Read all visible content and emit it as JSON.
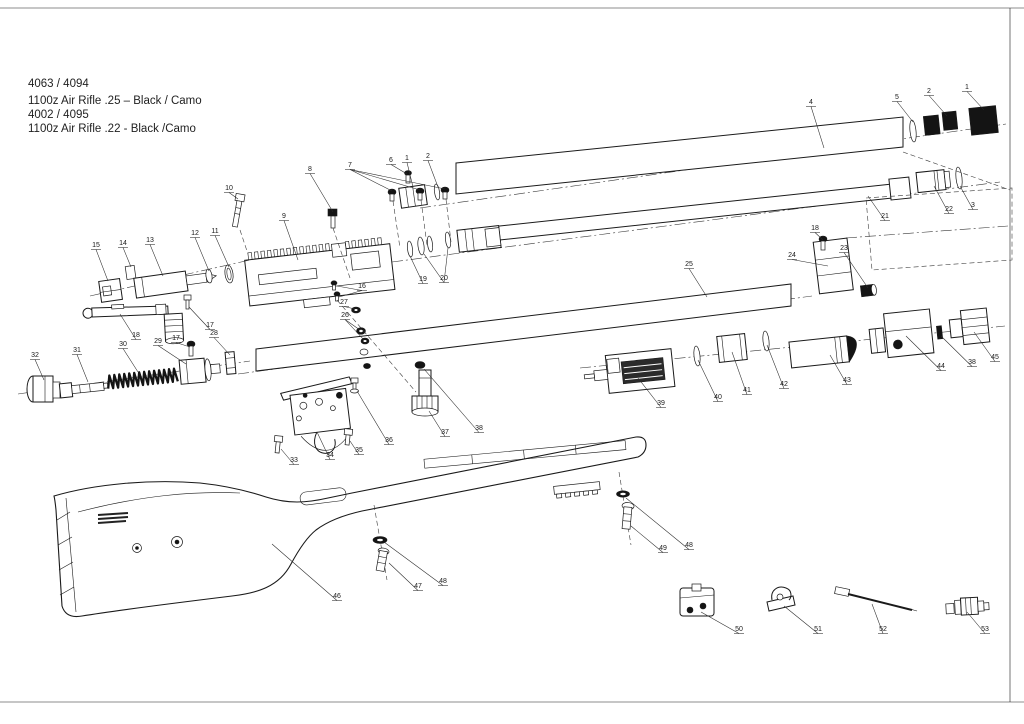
{
  "title_block": {
    "line1": "4063 / 4094",
    "line2": "1100z Air Rifle .25 – Black / Camo",
    "line3": "4002 / 4095",
    "line4": "1100z Air Rifle .22 - Black /Camo"
  },
  "diagram": {
    "type": "exploded-parts-diagram",
    "subject": "1100z PCP air rifle exploded view",
    "line_color": "#1a1a1a",
    "part_labels": [
      {
        "n": "1",
        "x": 967,
        "y": 89,
        "leaders": [
          [
            984,
            110
          ]
        ]
      },
      {
        "n": "2",
        "x": 929,
        "y": 93,
        "leaders": [
          [
            947,
            116
          ]
        ]
      },
      {
        "n": "5",
        "x": 897,
        "y": 99,
        "leaders": [
          [
            913,
            122
          ]
        ]
      },
      {
        "n": "4",
        "x": 811,
        "y": 104,
        "leaders": [
          [
            824,
            148
          ]
        ]
      },
      {
        "n": "3",
        "x": 973,
        "y": 207,
        "leaders": [
          [
            960,
            186
          ]
        ]
      },
      {
        "n": "22",
        "x": 949,
        "y": 211,
        "leaders": [
          [
            934,
            186
          ]
        ]
      },
      {
        "n": "21",
        "x": 885,
        "y": 218,
        "leaders": [
          [
            868,
            196
          ]
        ]
      },
      {
        "n": "18",
        "x": 815,
        "y": 230,
        "leaders": [
          [
            823,
            240
          ]
        ]
      },
      {
        "n": "23",
        "x": 844,
        "y": 250,
        "leaders": [
          [
            868,
            288
          ]
        ]
      },
      {
        "n": "24",
        "x": 792,
        "y": 257,
        "leaders": [
          [
            828,
            266
          ]
        ]
      },
      {
        "n": "25",
        "x": 689,
        "y": 266,
        "leaders": [
          [
            707,
            297
          ]
        ]
      },
      {
        "n": "9",
        "x": 284,
        "y": 218,
        "leaders": [
          [
            298,
            260
          ]
        ]
      },
      {
        "n": "10",
        "x": 229,
        "y": 190,
        "leaders": [
          [
            238,
            199
          ]
        ]
      },
      {
        "n": "8",
        "x": 310,
        "y": 171,
        "leaders": [
          [
            333,
            212
          ]
        ]
      },
      {
        "n": "7",
        "x": 350,
        "y": 167,
        "leaders": [
          [
            392,
            191
          ],
          [
            420,
            190
          ],
          [
            445,
            189
          ]
        ]
      },
      {
        "n": "6",
        "x": 391,
        "y": 162,
        "leaders": [
          [
            407,
            174
          ]
        ]
      },
      {
        "n": "1",
        "x": 407,
        "y": 160,
        "leaders": [
          [
            413,
            187
          ]
        ]
      },
      {
        "n": "2",
        "x": 428,
        "y": 158,
        "leaders": [
          [
            438,
            187
          ]
        ]
      },
      {
        "n": "19",
        "x": 423,
        "y": 281,
        "leaders": [
          [
            410,
            256
          ]
        ]
      },
      {
        "n": "20",
        "x": 444,
        "y": 280,
        "leaders": [
          [
            424,
            254
          ],
          [
            448,
            248
          ]
        ]
      },
      {
        "n": "15",
        "x": 96,
        "y": 247,
        "leaders": [
          [
            108,
            281
          ]
        ]
      },
      {
        "n": "14",
        "x": 123,
        "y": 245,
        "leaders": [
          [
            131,
            267
          ]
        ]
      },
      {
        "n": "13",
        "x": 150,
        "y": 242,
        "leaders": [
          [
            163,
            276
          ]
        ]
      },
      {
        "n": "12",
        "x": 195,
        "y": 235,
        "leaders": [
          [
            209,
            271
          ]
        ]
      },
      {
        "n": "11",
        "x": 215,
        "y": 233,
        "leaders": [
          [
            229,
            267
          ]
        ]
      },
      {
        "n": "18",
        "x": 136,
        "y": 337,
        "leaders": [
          [
            120,
            314
          ]
        ]
      },
      {
        "n": "17",
        "x": 210,
        "y": 327,
        "leaders": [
          [
            189,
            307
          ]
        ]
      },
      {
        "n": "28",
        "x": 214,
        "y": 335,
        "leaders": [
          [
            230,
            355
          ]
        ]
      },
      {
        "n": "17",
        "x": 176,
        "y": 340,
        "leaders": [
          [
            190,
            347
          ]
        ]
      },
      {
        "n": "29",
        "x": 158,
        "y": 343,
        "leaders": [
          [
            186,
            364
          ]
        ]
      },
      {
        "n": "30",
        "x": 123,
        "y": 346,
        "leaders": [
          [
            138,
            372
          ]
        ]
      },
      {
        "n": "31",
        "x": 77,
        "y": 352,
        "leaders": [
          [
            88,
            382
          ]
        ]
      },
      {
        "n": "32",
        "x": 35,
        "y": 357,
        "leaders": [
          [
            44,
            380
          ]
        ]
      },
      {
        "n": "16",
        "x": 362,
        "y": 288,
        "leaders": [
          [
            337,
            286
          ],
          [
            339,
            297
          ]
        ]
      },
      {
        "n": "27",
        "x": 344,
        "y": 304,
        "leaders": [
          [
            355,
            309
          ]
        ]
      },
      {
        "n": "26",
        "x": 345,
        "y": 317,
        "leaders": [
          [
            360,
            330
          ],
          [
            364,
            340
          ]
        ]
      },
      {
        "n": "33",
        "x": 294,
        "y": 462,
        "leaders": [
          [
            281,
            449
          ]
        ]
      },
      {
        "n": "34",
        "x": 330,
        "y": 457,
        "leaders": [
          [
            317,
            432
          ]
        ]
      },
      {
        "n": "35",
        "x": 359,
        "y": 452,
        "leaders": [
          [
            350,
            441
          ]
        ]
      },
      {
        "n": "36",
        "x": 389,
        "y": 442,
        "leaders": [
          [
            357,
            391
          ]
        ]
      },
      {
        "n": "37",
        "x": 445,
        "y": 434,
        "leaders": [
          [
            429,
            411
          ]
        ]
      },
      {
        "n": "38",
        "x": 479,
        "y": 430,
        "leaders": [
          [
            424,
            369
          ]
        ]
      },
      {
        "n": "39",
        "x": 661,
        "y": 405,
        "leaders": [
          [
            638,
            378
          ]
        ]
      },
      {
        "n": "40",
        "x": 718,
        "y": 399,
        "leaders": [
          [
            698,
            360
          ]
        ]
      },
      {
        "n": "41",
        "x": 747,
        "y": 392,
        "leaders": [
          [
            732,
            352
          ]
        ]
      },
      {
        "n": "42",
        "x": 784,
        "y": 386,
        "leaders": [
          [
            767,
            345
          ]
        ]
      },
      {
        "n": "43",
        "x": 847,
        "y": 382,
        "leaders": [
          [
            830,
            355
          ]
        ]
      },
      {
        "n": "44",
        "x": 941,
        "y": 368,
        "leaders": [
          [
            906,
            336
          ]
        ]
      },
      {
        "n": "38",
        "x": 972,
        "y": 364,
        "leaders": [
          [
            941,
            336
          ]
        ]
      },
      {
        "n": "45",
        "x": 995,
        "y": 359,
        "leaders": [
          [
            974,
            332
          ]
        ]
      },
      {
        "n": "46",
        "x": 337,
        "y": 598,
        "leaders": [
          [
            272,
            544
          ]
        ]
      },
      {
        "n": "47",
        "x": 418,
        "y": 588,
        "leaders": [
          [
            389,
            563
          ]
        ]
      },
      {
        "n": "48",
        "x": 443,
        "y": 583,
        "leaders": [
          [
            384,
            542
          ]
        ]
      },
      {
        "n": "49",
        "x": 663,
        "y": 550,
        "leaders": [
          [
            631,
            526
          ]
        ]
      },
      {
        "n": "48",
        "x": 689,
        "y": 547,
        "leaders": [
          [
            626,
            498
          ]
        ]
      },
      {
        "n": "50",
        "x": 739,
        "y": 631,
        "leaders": [
          [
            701,
            612
          ]
        ]
      },
      {
        "n": "51",
        "x": 818,
        "y": 631,
        "leaders": [
          [
            784,
            606
          ]
        ]
      },
      {
        "n": "52",
        "x": 883,
        "y": 631,
        "leaders": [
          [
            872,
            604
          ]
        ]
      },
      {
        "n": "53",
        "x": 985,
        "y": 631,
        "leaders": [
          [
            967,
            612
          ]
        ]
      }
    ]
  }
}
